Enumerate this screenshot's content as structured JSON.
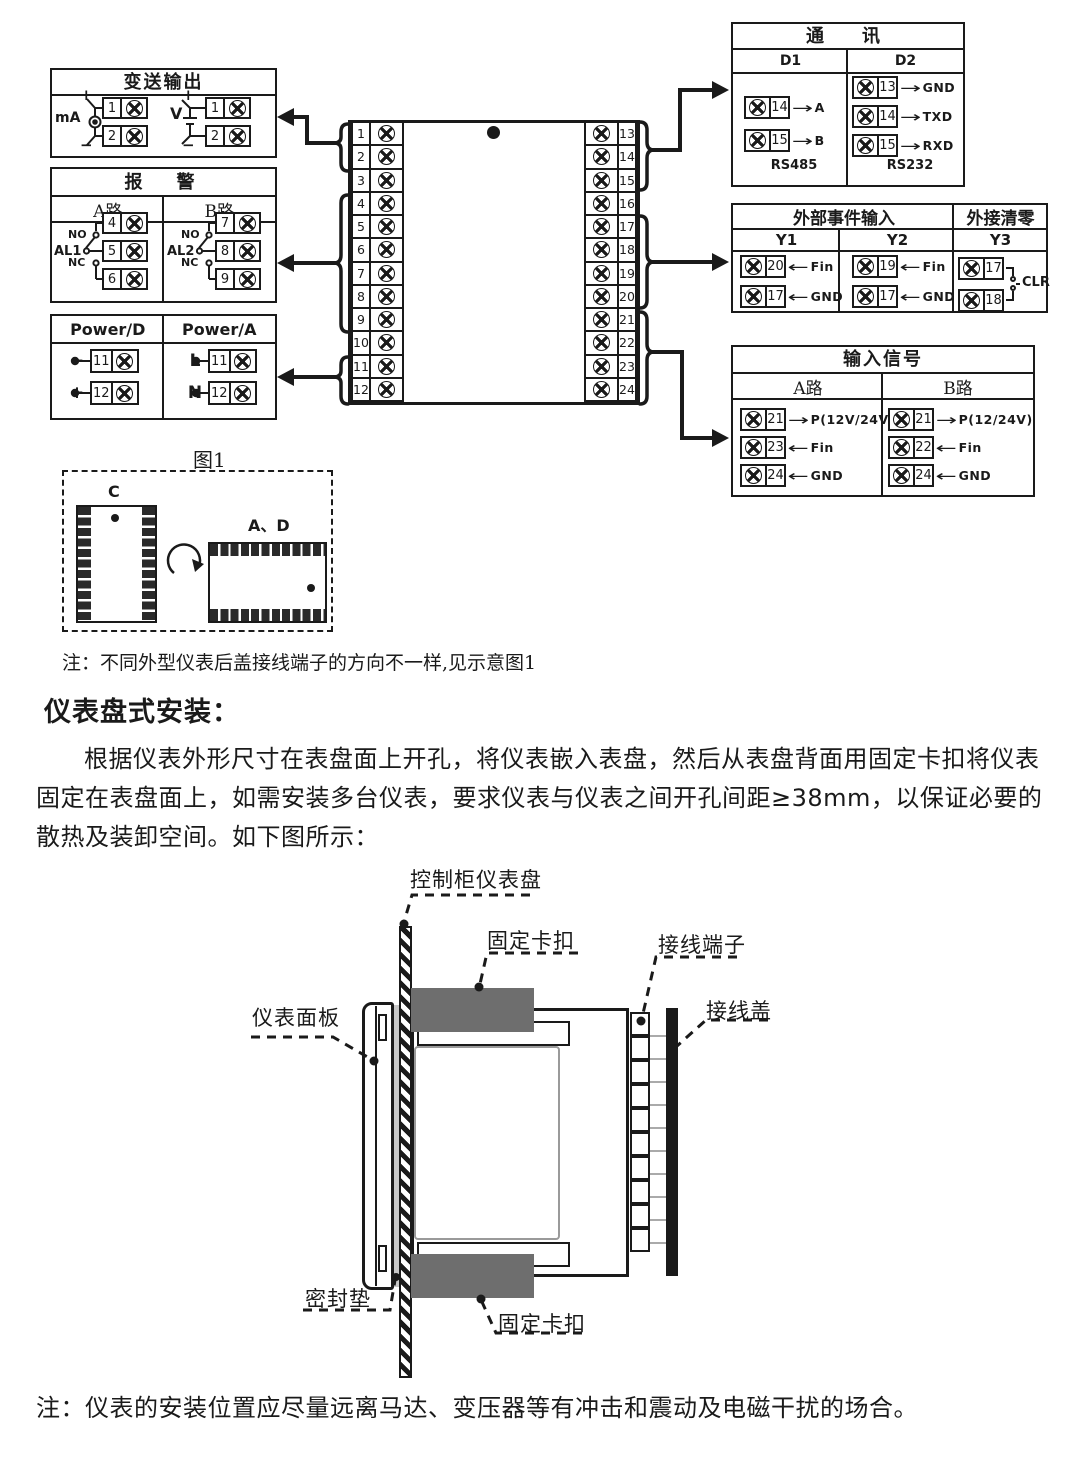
{
  "colors": {
    "ink": "#1a1a1a",
    "clip_gray": "#6e6e6e",
    "gasket_gray": "#c8c8c8"
  },
  "wiring": {
    "transmit_output": {
      "title": "变送输出",
      "ma_label": "mA",
      "v_label": "V",
      "plus": "+",
      "minus": "−",
      "ma_terminals": [
        "1",
        "2"
      ],
      "v_terminals": [
        "1",
        "2"
      ]
    },
    "alarm": {
      "title": "报　警",
      "channel_a": {
        "header": "A路",
        "relay": "AL1",
        "no": "NO",
        "nc": "NC",
        "terminals": [
          "4",
          "5",
          "6"
        ]
      },
      "channel_b": {
        "header": "B路",
        "relay": "AL2",
        "no": "NO",
        "nc": "NC",
        "terminals": [
          "7",
          "8",
          "9"
        ]
      }
    },
    "power": {
      "dc": {
        "header": "Power/D",
        "rows": [
          {
            "sign": "−",
            "num": "11"
          },
          {
            "sign": "+",
            "num": "12"
          }
        ]
      },
      "ac": {
        "header": "Power/A",
        "rows": [
          {
            "sign": "L",
            "num": "11"
          },
          {
            "sign": "N",
            "num": "12"
          }
        ]
      }
    },
    "terminal_block": {
      "left": [
        "1",
        "2",
        "3",
        "4",
        "5",
        "6",
        "7",
        "8",
        "9",
        "10",
        "11",
        "12"
      ],
      "right": [
        "13",
        "14",
        "15",
        "16",
        "17",
        "18",
        "19",
        "20",
        "21",
        "22",
        "23",
        "24"
      ]
    },
    "comm": {
      "title": "通　讯",
      "d1": {
        "header": "D1",
        "footer": "RS485",
        "rows": [
          {
            "num": "14",
            "dir": "→",
            "label": "A"
          },
          {
            "num": "15",
            "dir": "→",
            "label": "B"
          }
        ]
      },
      "d2": {
        "header": "D2",
        "footer": "RS232",
        "rows": [
          {
            "num": "13",
            "dir": "→",
            "label": "GND"
          },
          {
            "num": "14",
            "dir": "→",
            "label": "TXD"
          },
          {
            "num": "15",
            "dir": "→",
            "label": "RXD"
          }
        ]
      }
    },
    "event_input": {
      "title": "外部事件输入",
      "clear_title": "外接清零",
      "y1": {
        "header": "Y1",
        "rows": [
          {
            "num": "20",
            "dir": "←",
            "label": "Fin"
          },
          {
            "num": "17",
            "dir": "←",
            "label": "GND"
          }
        ]
      },
      "y2": {
        "header": "Y2",
        "rows": [
          {
            "num": "19",
            "dir": "←",
            "label": "Fin"
          },
          {
            "num": "17",
            "dir": "←",
            "label": "GND"
          }
        ]
      },
      "y3": {
        "header": "Y3",
        "terminals": [
          "17",
          "18"
        ],
        "label": "CLR"
      }
    },
    "input_signal": {
      "title": "输入信号",
      "a": {
        "header": "A路",
        "rows": [
          {
            "num": "21",
            "dir": "→",
            "label": "P(12V/24V)"
          },
          {
            "num": "23",
            "dir": "←",
            "label": "Fin"
          },
          {
            "num": "24",
            "dir": "←",
            "label": "GND"
          }
        ]
      },
      "b": {
        "header": "B路",
        "rows": [
          {
            "num": "21",
            "dir": "→",
            "label": "P(12/24V)"
          },
          {
            "num": "22",
            "dir": "←",
            "label": "Fin"
          },
          {
            "num": "24",
            "dir": "←",
            "label": "GND"
          }
        ]
      }
    }
  },
  "figure1": {
    "caption": "图1",
    "c_label": "C",
    "ad_label": "A、D"
  },
  "notes": {
    "fig_note": "注：不同外型仪表后盖接线端子的方向不一样,见示意图1",
    "bottom_note": "注：仪表的安装位置应尽量远离马达、变压器等有冲击和震动及电磁干扰的场合。"
  },
  "install": {
    "heading": "仪表盘式安装：",
    "paragraph": "根据仪表外形尺寸在表盘面上开孔，将仪表嵌入表盘，然后从表盘背面用固定卡扣将仪表固定在表盘面上，如需安装多台仪表，要求仪表与仪表之间开孔间距≥38mm，以保证必要的散热及装卸空间。如下图所示：",
    "labels": {
      "panel": "控制柜仪表盘",
      "clip_top": "固定卡扣",
      "terminal": "接线端子",
      "cover": "接线盖",
      "faceplate": "仪表面板",
      "gasket": "密封垫",
      "clip_bottom": "固定卡扣"
    }
  }
}
